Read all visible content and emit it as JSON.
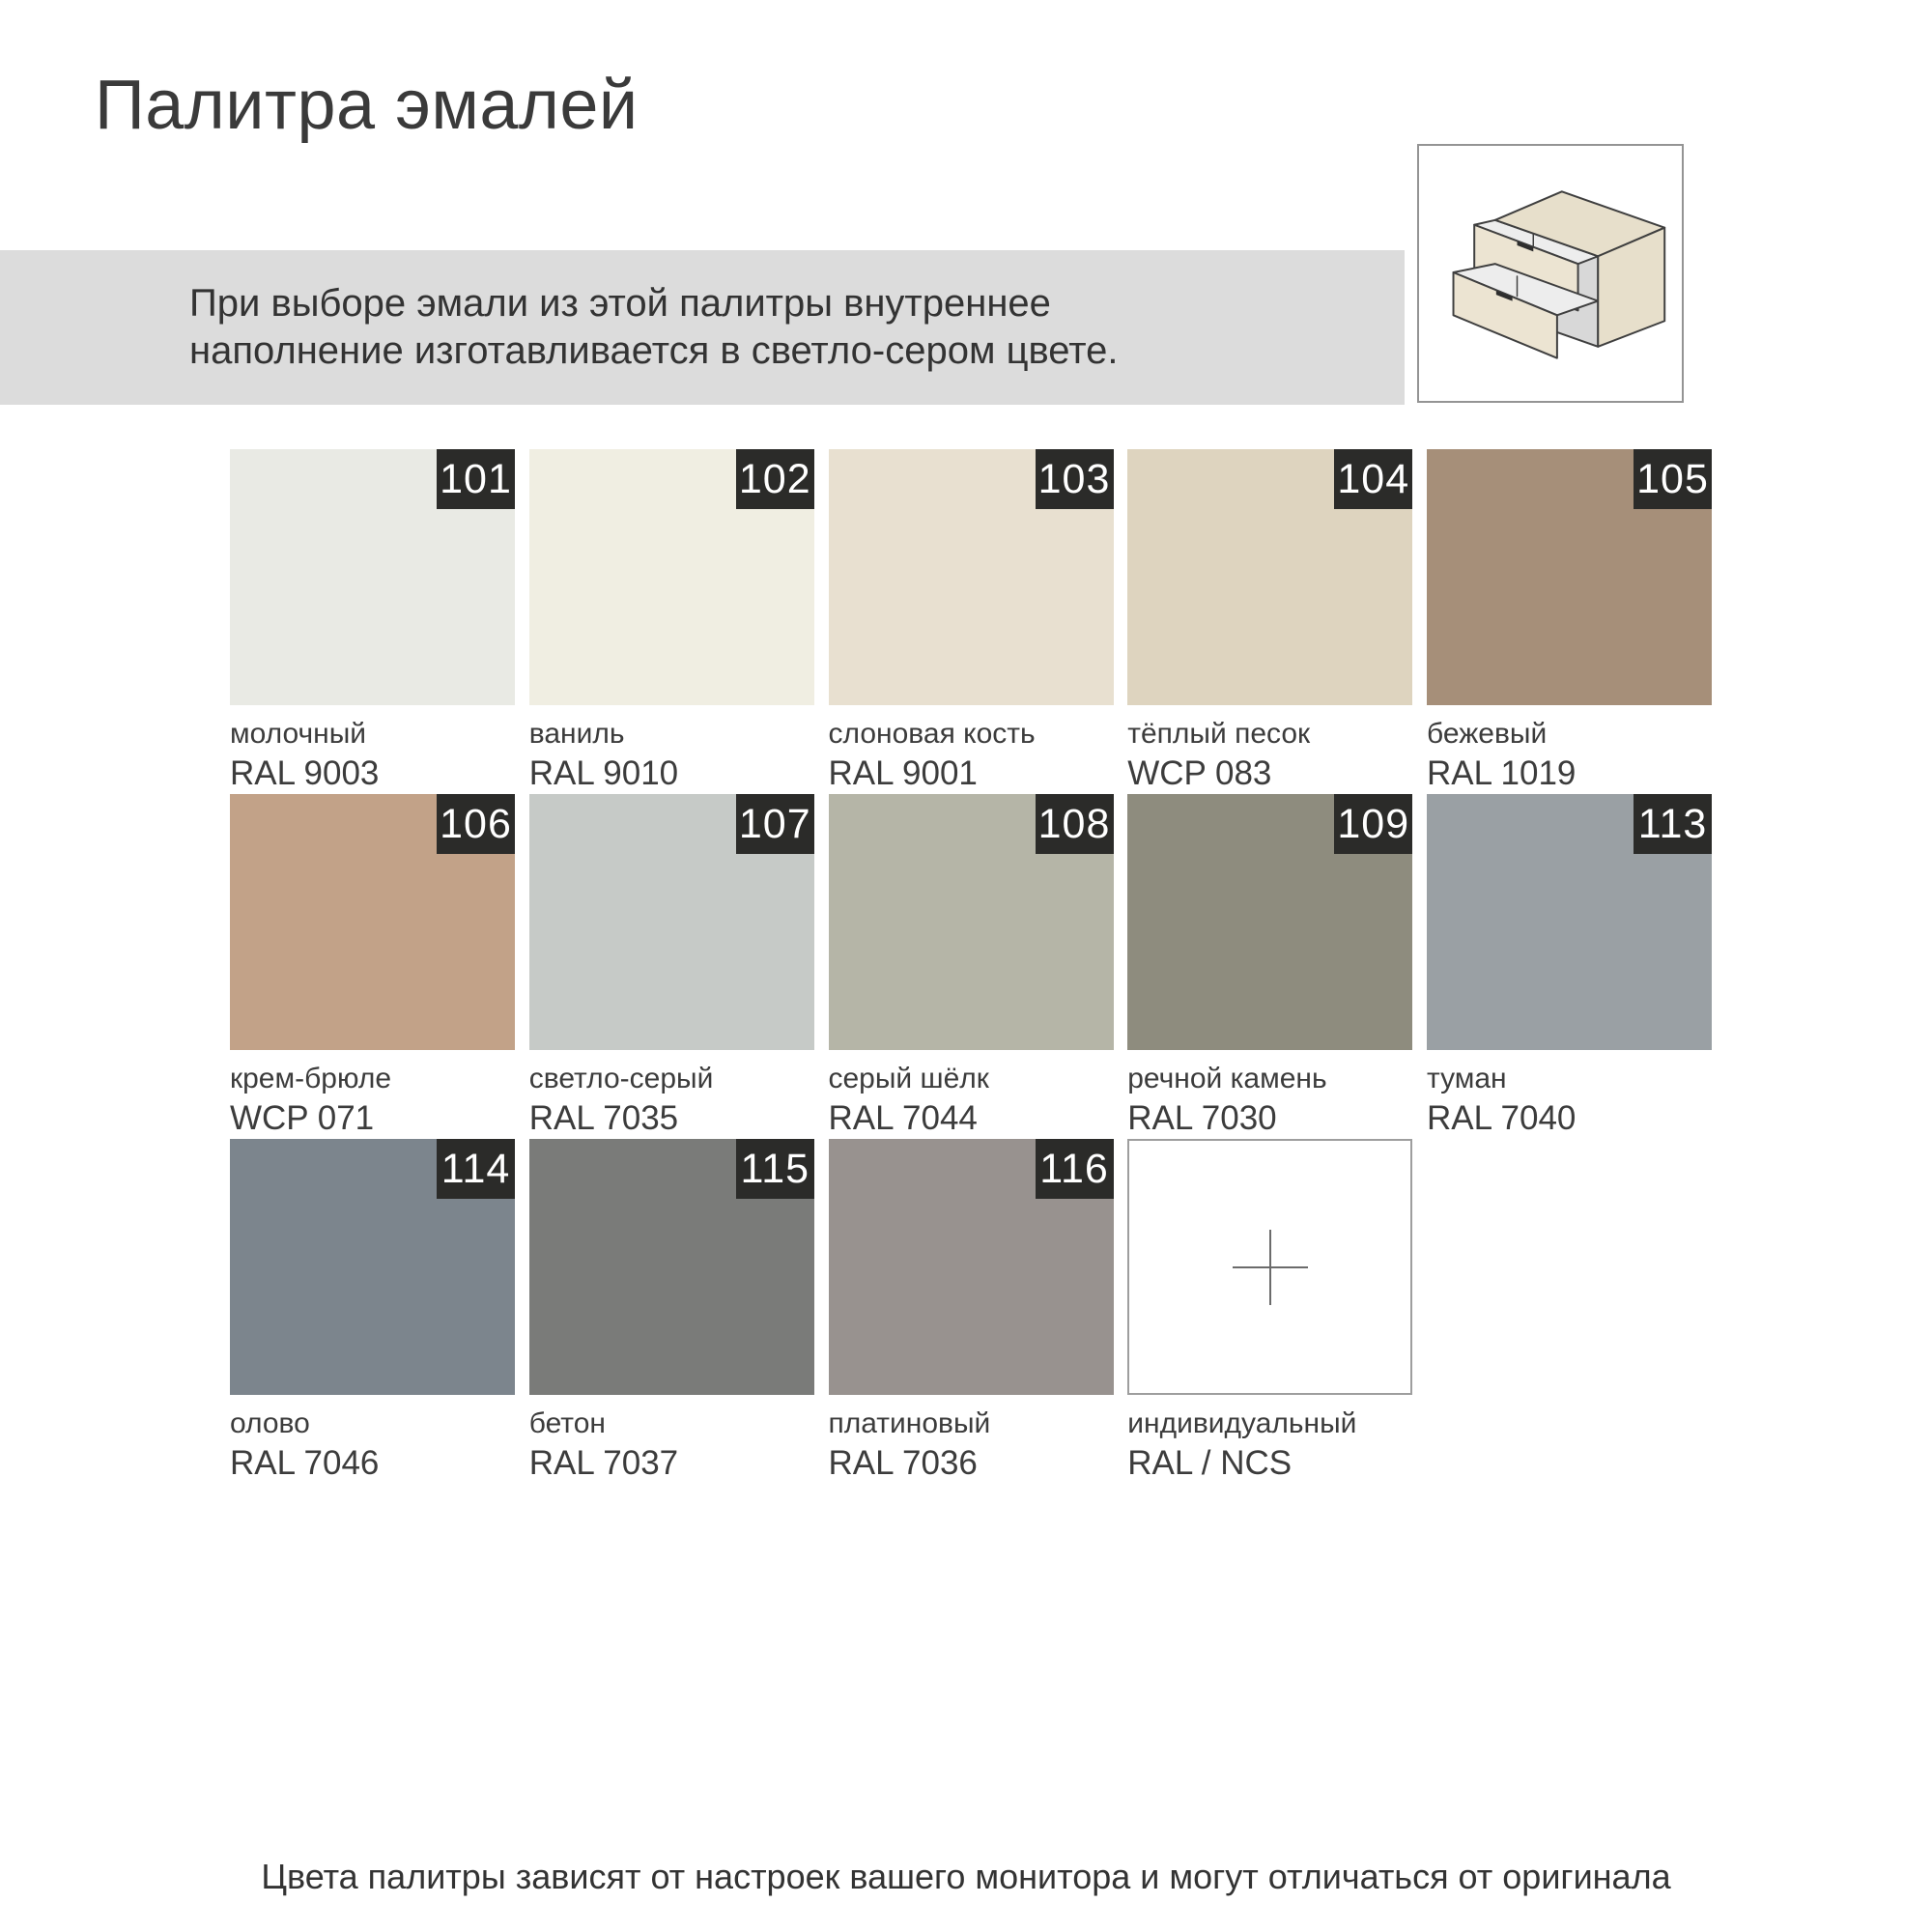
{
  "title": "Палитра эмалей",
  "banner": {
    "line1": "При выборе эмали из этой палитры внутреннее",
    "line2": "наполнение изготавливается в светло-сером цвете.",
    "background": "#dcdcdc"
  },
  "drawer_illustration": {
    "description": "cabinet-with-two-open-drawers",
    "body_color": "#e7dfcb",
    "front_color": "#ece4d2",
    "interior_color": "#d8d8d8",
    "drawer_top_color": "#ededed",
    "outline_color": "#3f3f3f",
    "handle_color": "#2e2e2e"
  },
  "palette": {
    "badge_bg": "#2b2b29",
    "badge_text_color": "#ffffff",
    "swatches": [
      {
        "code": "101",
        "name": "молочный",
        "standard": "RAL 9003",
        "hex": "#e9eae4"
      },
      {
        "code": "102",
        "name": "ваниль",
        "standard": "RAL 9010",
        "hex": "#f0eee2"
      },
      {
        "code": "103",
        "name": "слоновая кость",
        "standard": "RAL 9001",
        "hex": "#e8e0d0"
      },
      {
        "code": "104",
        "name": "тёплый песок",
        "standard": "WCP 083",
        "hex": "#ded4bf"
      },
      {
        "code": "105",
        "name": "бежевый",
        "standard": "RAL 1019",
        "hex": "#a68f79"
      },
      {
        "code": "106",
        "name": "крем-брюле",
        "standard": "WCP 071",
        "hex": "#c2a288"
      },
      {
        "code": "107",
        "name": "светло-серый",
        "standard": "RAL 7035",
        "hex": "#c6cac7"
      },
      {
        "code": "108",
        "name": "серый шёлк",
        "standard": "RAL 7044",
        "hex": "#b5b5a7"
      },
      {
        "code": "109",
        "name": "речной камень",
        "standard": "RAL 7030",
        "hex": "#8e8c7e"
      },
      {
        "code": "113",
        "name": "туман",
        "standard": "RAL 7040",
        "hex": "#9aa0a4"
      },
      {
        "code": "114",
        "name": "олово",
        "standard": "RAL 7046",
        "hex": "#7c858d"
      },
      {
        "code": "115",
        "name": "бетон",
        "standard": "RAL 7037",
        "hex": "#7a7b79"
      },
      {
        "code": "116",
        "name": "платиновый",
        "standard": "RAL 7036",
        "hex": "#98928f"
      },
      {
        "code": "",
        "name": "индивидуальный",
        "standard": "RAL / NCS",
        "hex": "#ffffff",
        "custom": true
      }
    ]
  },
  "footer": "Цвета палитры зависят от настроек вашего монитора и могут отличаться от оригинала"
}
